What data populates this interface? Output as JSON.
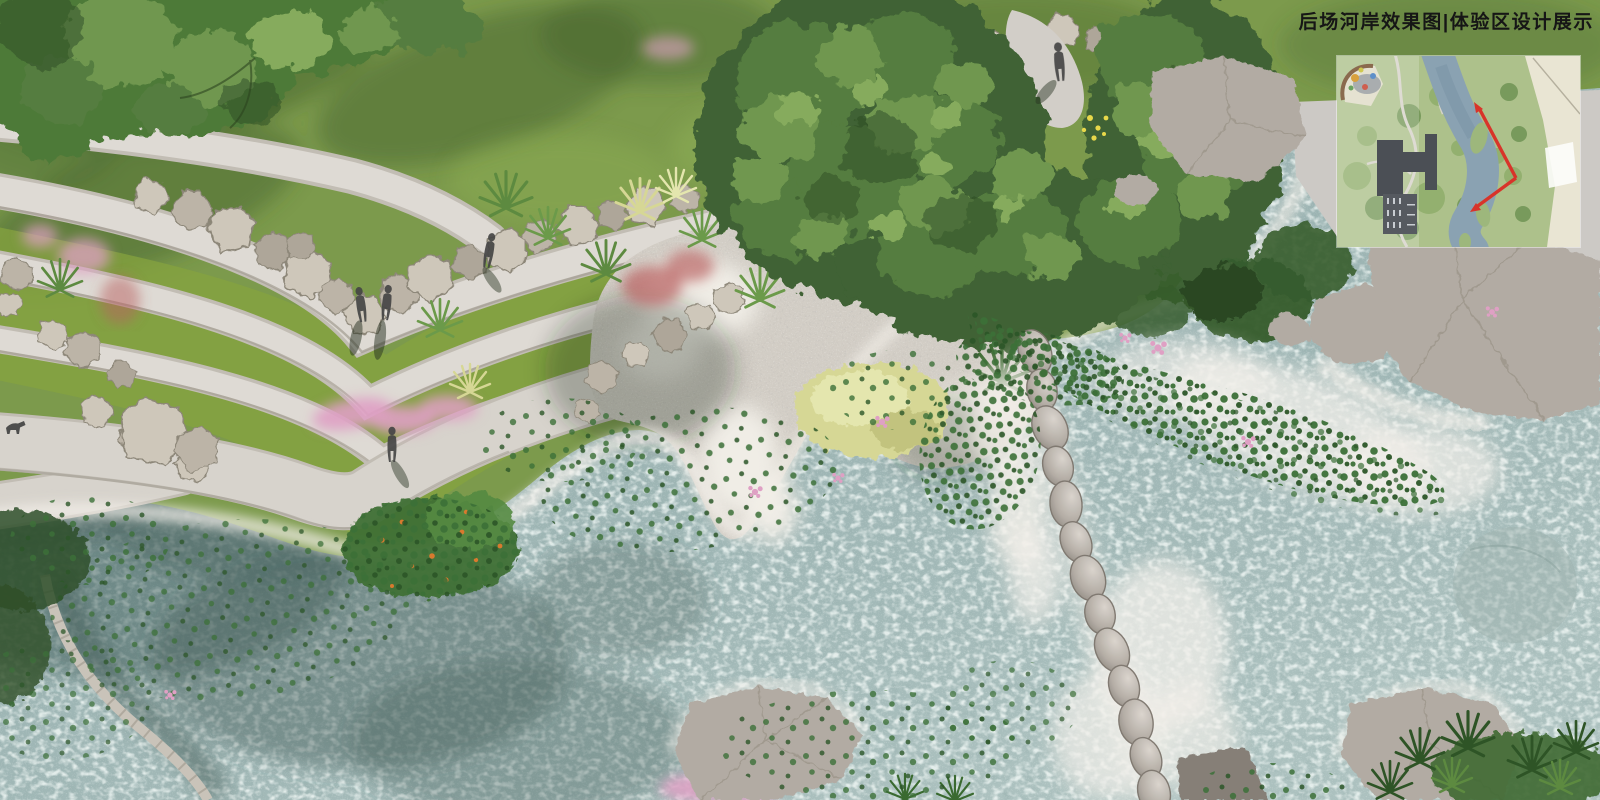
{
  "title": {
    "text": "后场河岸效果图|体验区设计展示"
  },
  "inset_map": {
    "kind": "site-plan-locator",
    "features": [
      "playground",
      "parking-lot",
      "building",
      "winding-river",
      "paths",
      "tree-canopies",
      "view-direction-arrows"
    ],
    "arrows": {
      "count": 2,
      "meaning": "camera view direction",
      "color": "#d8342a"
    }
  },
  "scene": {
    "kind": "aerial-landscape-architecture-rendering",
    "subject": "riverbank experience zone",
    "elements": {
      "lawn": "green lawn upper left and top",
      "terraced_paths": "curved white concrete terraces forming a V",
      "rock_retaining_wall": "band of beige landscape rocks",
      "gravel_beach": "pebble beach with white sand",
      "stream": "shallow mottled teal water",
      "stone_weir": "chain of grey boulders crossing the stream",
      "trees": "large green canopies top-left and center",
      "aquatic_plants": "lily pads, pink blooms, orange-flower bed",
      "pink_grasses": "muhly grass clusters",
      "boulders": "large grey rocks along shores"
    },
    "figures": {
      "pedestrians": 5,
      "dog": 1
    }
  },
  "colors": {
    "lawn": "#7c9a4c",
    "lawn_shadow": "#41602d",
    "lawn_bright": "#8fb055",
    "grass_strip": "#85a33f",
    "canopy": "#3f6234",
    "canopy_mid": "#557d3f",
    "canopy_light": "#6f9750",
    "canopy_xlight": "#86ab5d",
    "canopy_deep": "#2d4a24",
    "topleft_tree": "#4e7a39",
    "path": "#dedad4",
    "path_edge": "#c2bdb4",
    "path_wide": "#d7d3cc",
    "wall_line": "#a39c91",
    "rock_a": "#cec7ba",
    "rock_b": "#bcb4a7",
    "rock_c": "#aea699",
    "rock_line": "#8d8779",
    "boulder_hi": "#dad4cd",
    "boulder": "#b2aba3",
    "boulder_lo": "#867f77",
    "gravel": "#d2cdc5",
    "sand": "#f0ede6",
    "water": "#9cb4b3",
    "water_light": "#c3d5d1",
    "water_deep": "#6d8a87",
    "water_shadow": "#445f5b",
    "channel": "#3f5853",
    "foam": "#f2efe9",
    "pad": "#3c7038",
    "pad_dark": "#2c5628",
    "pink": "#dfa0c4",
    "red_accent": "#b96060",
    "orange": "#d97a2e",
    "yellow_grass": "#d6d795",
    "yellow_grass_hi": "#e4e6ae",
    "shrub": "#365c2d",
    "figure": "#454545",
    "shadow": "#26301f",
    "title": "#161616",
    "inset_bg": "#adc18b",
    "inset_tree": "#8fae6b",
    "inset_tree_dark": "#6f9454",
    "inset_river": "#8aa2b2",
    "inset_river_dark": "#7b94a6",
    "inset_island": "#9db77c",
    "inset_path": "#d6d3c9",
    "inset_building": "#4b4f55",
    "inset_parking": "#565a60",
    "inset_beige": "#e9e5d3",
    "inset_white": "#fdfdfb",
    "inset_brown": "#8a6a4e",
    "play_orange": "#d9a13e",
    "play_red": "#cf5f4f",
    "play_blue": "#5f8fc9",
    "play_yellow": "#cfc94f",
    "play_green": "#6aa35f",
    "arrow": "#d8342a"
  }
}
